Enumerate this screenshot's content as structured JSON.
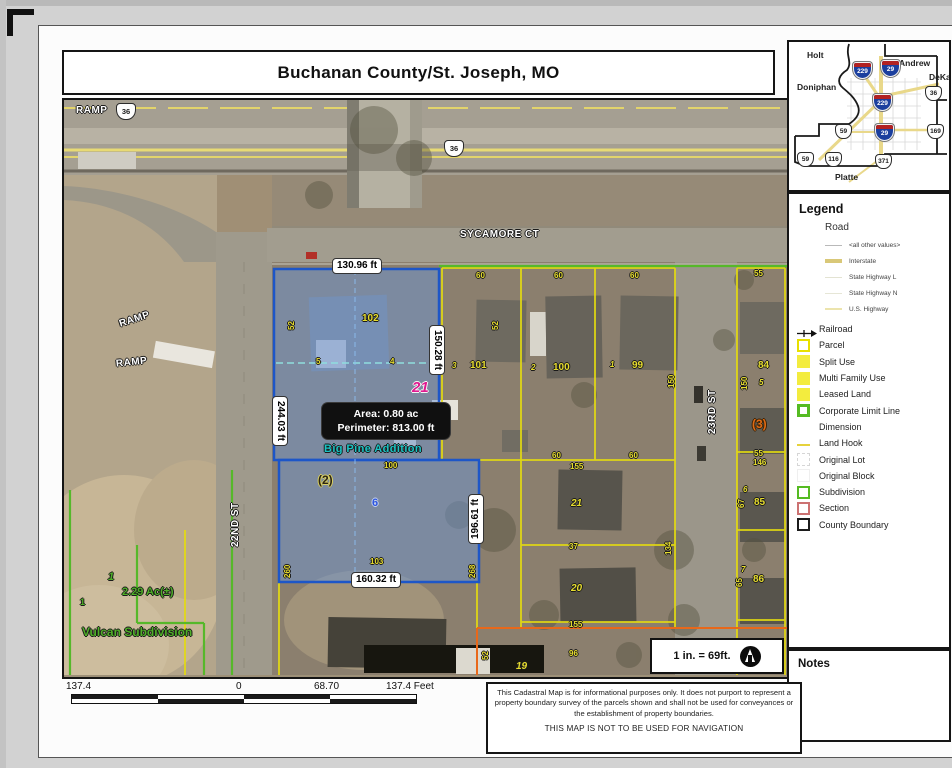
{
  "title": "Buchanan County/St. Joseph, MO",
  "inset": {
    "counties": {
      "holt": "Holt",
      "andrew": "Andrew",
      "dekalb": "DeKalb",
      "doniphan": "Doniphan",
      "platte": "Platte"
    },
    "shields": {
      "i229a": "229",
      "i29a": "29",
      "i229b": "229",
      "i29b": "29",
      "us36": "36",
      "us59a": "59",
      "us169": "169",
      "us59b": "59",
      "us116": "116",
      "us371": "371"
    }
  },
  "legend": {
    "title": "Legend",
    "road_group": "Road",
    "road_items": [
      {
        "label": "<all other values>",
        "symbol": "thin-gray-line"
      },
      {
        "label": "Interstate",
        "symbol": "thick-tan-line"
      },
      {
        "label": "State Highway L",
        "symbol": "thin-pale-line"
      },
      {
        "label": "State Highway N",
        "symbol": "thin-pale-line"
      },
      {
        "label": "U.S. Highway",
        "symbol": "pale-yellow-line"
      }
    ],
    "items": [
      {
        "label": "Railroad",
        "symbol": "railroad-arrow"
      },
      {
        "label": "Parcel",
        "symbol": "yellow-outline-square"
      },
      {
        "label": "Split Use",
        "symbol": "yellow-filled-square"
      },
      {
        "label": "Multi Family Use",
        "symbol": "yellow-filled-square"
      },
      {
        "label": "Leased Land",
        "symbol": "yellow-filled-square"
      },
      {
        "label": "Corporate Limit Line",
        "symbol": "green-outline-square"
      },
      {
        "label": "Dimension",
        "symbol": "none"
      },
      {
        "label": "Land Hook",
        "symbol": "yellow-dash"
      },
      {
        "label": "Original Lot",
        "symbol": "dashed-outline-square"
      },
      {
        "label": "Original Block",
        "symbol": "faint-square"
      },
      {
        "label": "Subdivision",
        "symbol": "green-outline-square"
      },
      {
        "label": "Section",
        "symbol": "red-outline-square"
      },
      {
        "label": "County Boundary",
        "symbol": "black-outline-square"
      }
    ]
  },
  "notes": {
    "title": "Notes"
  },
  "scalebar": {
    "far_left": "137.4",
    "zero": "0",
    "mid": "68.70",
    "far_right": "137.4 Feet"
  },
  "scale_note": "1 in. = 69ft.",
  "disclaimer": {
    "body": "This Cadastral Map is for informational purposes only.  It does not purport to represent a property boundary survey of the parcels shown and shall not be used for conveyances or the establishment of property boundaries.",
    "warning": "THIS MAP IS NOT TO BE USED FOR NAVIGATION"
  },
  "map": {
    "streets": {
      "ramp_nw": "RAMP",
      "ramp_w1": "RAMP",
      "ramp_w2": "RAMP",
      "sycamore": "SYCAMORE CT",
      "st22": "22ND ST",
      "st23": "23RD ST"
    },
    "shields": {
      "a": "36",
      "b": "36"
    },
    "dims": {
      "top": "130.96 ft",
      "right": "150.28 ft",
      "left": "244.03 ft",
      "bottom": "160.32 ft",
      "lower_right": "196.61 ft"
    },
    "selected": {
      "area": "Area: 0.80 ac",
      "perimeter": "Perimeter: 813.00 ft",
      "lot_upper": "102",
      "lot_lower": "103",
      "block": "21",
      "subdivision": "Big Pine Addition",
      "circled": "(2)",
      "house_number": "6",
      "num_100": "100",
      "side_w": "52",
      "side_e": "52",
      "hook_a": "5",
      "hook_b": "4",
      "side_sw": "260",
      "side_se": "268"
    },
    "row": {
      "w1": "60",
      "w2": "60",
      "w3": "60",
      "w4": "55",
      "p101_pre": "3",
      "p101": "101",
      "p100_pre": "2",
      "p100": "100",
      "p99_pre": "1",
      "p99": "99",
      "d150a": "150",
      "d150b": "150",
      "p84": "84",
      "p84_sub": "5"
    },
    "mid": {
      "w1": "60",
      "w2": "60",
      "d155a": "155",
      "p21": "21",
      "d37": "37",
      "p20": "20",
      "d134": "134",
      "d155b": "155",
      "p96": "96",
      "p19": "19",
      "d52": "52"
    },
    "right": {
      "circled": "(3)",
      "d55": "55",
      "d146": "146",
      "p85_pre": "6",
      "d67": "67",
      "p85": "85",
      "p86_pre": "7",
      "d65": "65",
      "p86": "86"
    },
    "vulcan": {
      "n1": "1",
      "area": "2.29 Ac(±)",
      "n2": "1",
      "name": "Vulcan Subdivision"
    }
  },
  "colors": {
    "parcel_yellow": "#e8e000",
    "corporate_green": "#55bb22",
    "selected_blue": "#1d56c8",
    "magenta": "#e01990",
    "teal": "#1ac4c4",
    "vulcan_green": "#4fae28",
    "section_orange": "#e8681a",
    "interstate_blue": "#1b3f9e",
    "interstate_red": "#b22222"
  }
}
